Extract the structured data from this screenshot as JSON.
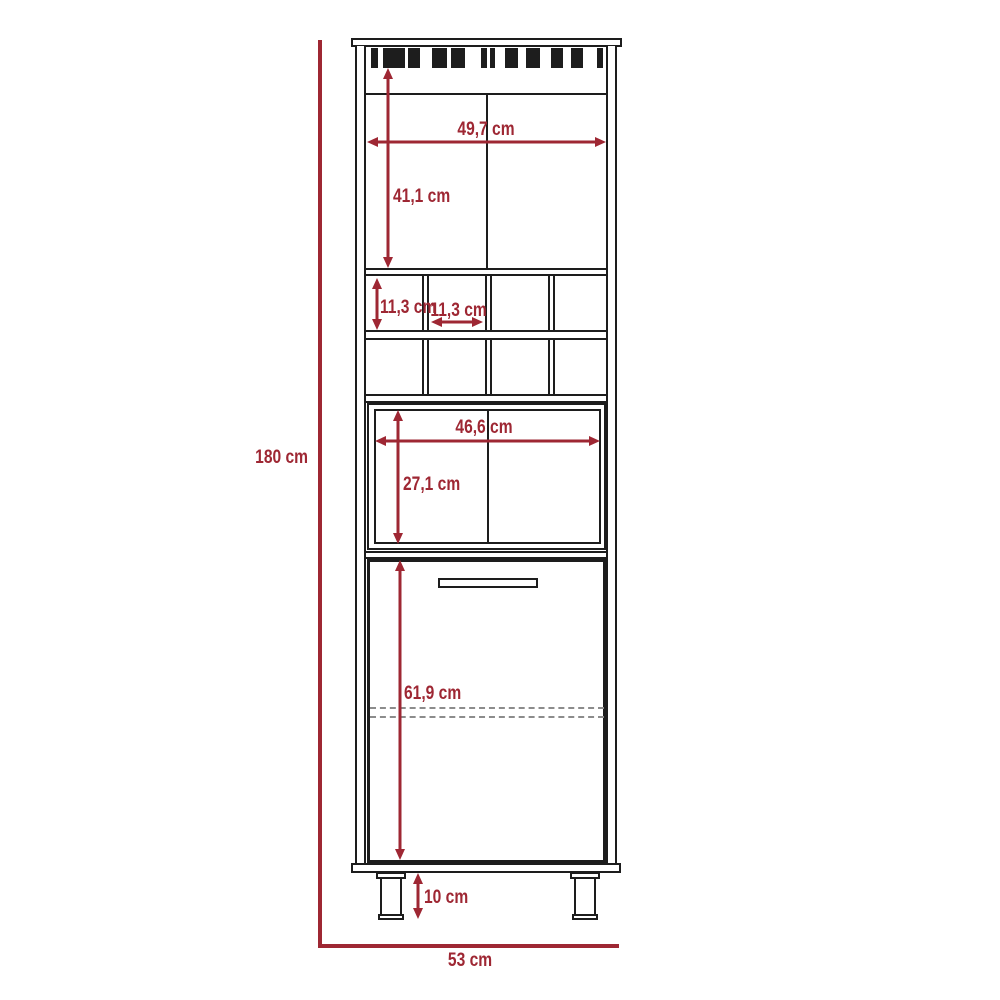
{
  "diagram": {
    "subject": "bar-cabinet-dimension-drawing",
    "colors": {
      "dimension_color": "#9E2733",
      "outline_color": "#1D1D1D",
      "hidden_line_color": "#8C8C8C",
      "background": "#FFFFFF"
    },
    "dimensions": {
      "overall_height": "180 cm",
      "overall_width": "53 cm",
      "upper_compartment_width": "49,7 cm",
      "upper_compartment_height": "41,1 cm",
      "wine_cubby_height": "11,3 cm",
      "wine_cubby_width": "11,3 cm",
      "middle_compartment_width": "46,6 cm",
      "middle_compartment_height": "27,1 cm",
      "door_height": "61,9 cm",
      "leg_height": "10 cm"
    }
  }
}
